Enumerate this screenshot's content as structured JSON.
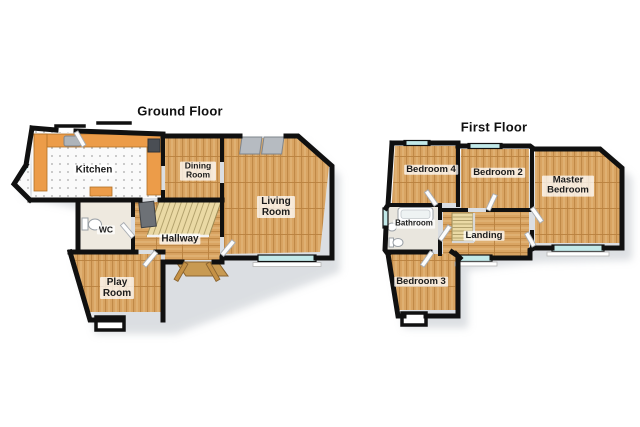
{
  "canvas": {
    "width": 640,
    "height": 427,
    "background": "#ffffff"
  },
  "floors": [
    {
      "id": "ground-floor",
      "title": "Ground Floor",
      "rooms": [
        {
          "id": "kitchen",
          "label": "Kitchen"
        },
        {
          "id": "dining-room",
          "label": "Dining Room"
        },
        {
          "id": "living-room",
          "label": "Living Room"
        },
        {
          "id": "wc",
          "label": "WC"
        },
        {
          "id": "hallway",
          "label": "Hallway"
        },
        {
          "id": "play-room",
          "label": "Play Room"
        }
      ],
      "fixtures": [
        "kitchen-counter",
        "kitchen-sink",
        "cooktop",
        "staircase",
        "front-door",
        "patio-doors",
        "toilet",
        "bay-window",
        "porch"
      ]
    },
    {
      "id": "first-floor",
      "title": "First Floor",
      "rooms": [
        {
          "id": "bedroom-4",
          "label": "Bedroom 4"
        },
        {
          "id": "bedroom-2",
          "label": "Bedroom 2"
        },
        {
          "id": "master-bedroom",
          "label": "Master Bedroom"
        },
        {
          "id": "bathroom",
          "label": "Bathroom"
        },
        {
          "id": "landing",
          "label": "Landing"
        },
        {
          "id": "bedroom-3",
          "label": "Bedroom 3"
        }
      ],
      "fixtures": [
        "bathtub",
        "bathroom-sink",
        "toilet",
        "stairwell-banister",
        "windows",
        "porch"
      ]
    }
  ],
  "colors": {
    "wall": "#101010",
    "wood_floor": "#d9a462",
    "wood_grain": "#c08947",
    "kitchen_floor": "#fafafa",
    "counter": "#ec9c49",
    "stairs": "#ead9a4",
    "window_glass": "#c2e9e9",
    "door_wood": "#c59145",
    "label_text": "#1b1b1b",
    "label_background": "rgba(255,255,255,0.75)",
    "shadow": "#b9bfc6"
  }
}
